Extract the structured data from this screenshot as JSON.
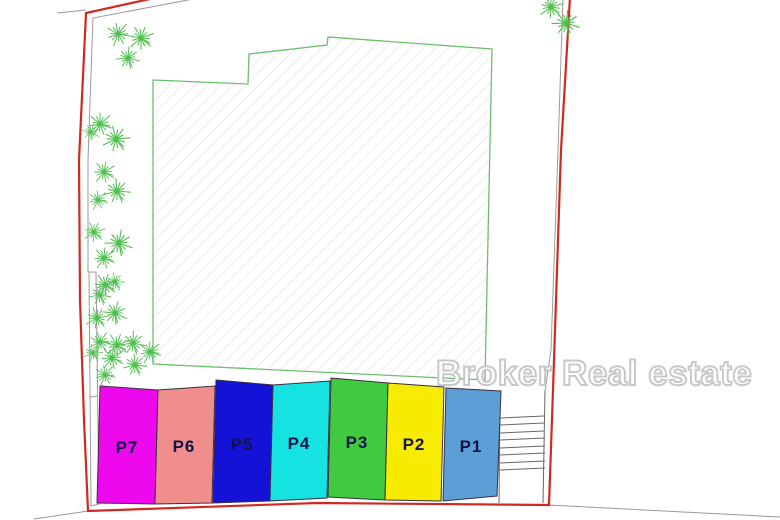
{
  "plan": {
    "watermark": "Broker Real estate",
    "parking_stalls": [
      {
        "label": "P7",
        "color": "#ee08ee"
      },
      {
        "label": "P6",
        "color": "#f08d8d"
      },
      {
        "label": "P5",
        "color": "#1412d6"
      },
      {
        "label": "P4",
        "color": "#16e2e2"
      },
      {
        "label": "P3",
        "color": "#3fca40"
      },
      {
        "label": "P2",
        "color": "#f7eb00"
      },
      {
        "label": "P1",
        "color": "#5b9fd6"
      }
    ],
    "colors": {
      "boundary": "#cf2a21",
      "inner_line": "#9a9a9a",
      "building_outline": "#6cc06c",
      "hatch": "#e9dbe3",
      "tree": "#4cbf4c",
      "stall_label": "#131347",
      "stairs": "#666666",
      "watermark_fill": "#ffffff",
      "watermark_outline": "#c6c6c6"
    }
  }
}
